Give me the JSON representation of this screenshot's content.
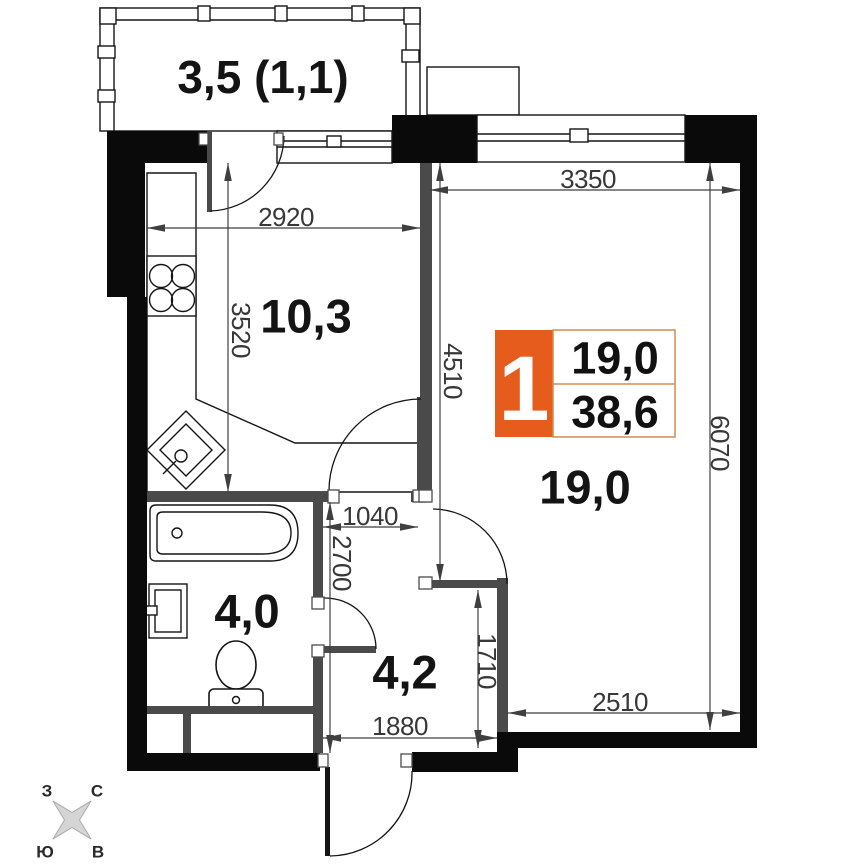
{
  "plan": {
    "rooms": [
      {
        "id": "balcony",
        "area_label": "3,5 (1,1)"
      },
      {
        "id": "kitchen",
        "area_label": "10,3"
      },
      {
        "id": "living-room",
        "area_label": "19,0"
      },
      {
        "id": "bathroom",
        "area_label": "4,0"
      },
      {
        "id": "hallway",
        "area_label": "4,2"
      }
    ],
    "dimensions_mm": [
      {
        "id": "kitchen-width",
        "value": "2920"
      },
      {
        "id": "kitchen-depth",
        "value": "3520"
      },
      {
        "id": "living-window-width",
        "value": "3350"
      },
      {
        "id": "living-upper-depth",
        "value": "4510"
      },
      {
        "id": "living-full-depth",
        "value": "6070"
      },
      {
        "id": "hall-door-width",
        "value": "1040"
      },
      {
        "id": "hall-depth",
        "value": "2700"
      },
      {
        "id": "hall-lower-depth",
        "value": "1710"
      },
      {
        "id": "hall-width",
        "value": "1880"
      },
      {
        "id": "living-lower-width",
        "value": "2510"
      }
    ],
    "info_badge": {
      "rooms_count": "1",
      "living_area": "19,0",
      "total_area": "38,6"
    },
    "compass": {
      "west": "З",
      "north": "С",
      "south": "Ю",
      "east": "В"
    },
    "colors": {
      "wall": "#0a0a0a",
      "partition": "#4a4a4a",
      "accent_orange": "#e65c1d",
      "badge_border": "#d08c50",
      "dimension": "#3f3f3f",
      "compass_star": "#d6d6d6"
    }
  }
}
